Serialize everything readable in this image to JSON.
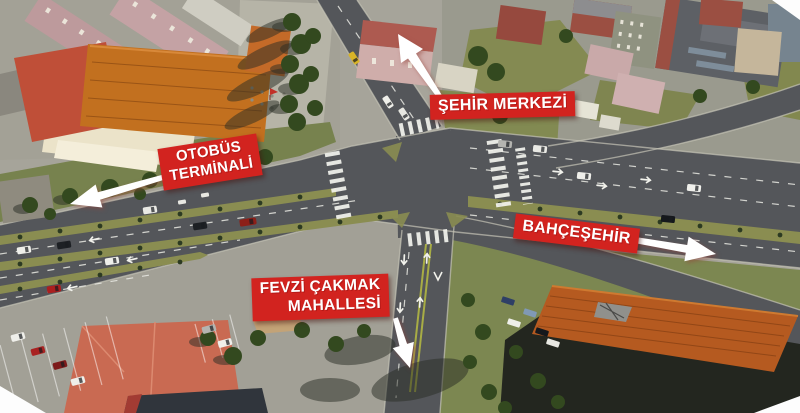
{
  "labels": {
    "city_center": "ŞEHİR MERKEZİ",
    "bus_terminal_line1": "OTOBÜS",
    "bus_terminal_line2": "TERMİNALİ",
    "bahcesehir": "BAHÇEŞEHİR",
    "fevzi_cakmak_line1": "FEVZİ ÇAKMAK",
    "fevzi_cakmak_line2": "MAHALLESİ"
  },
  "colors": {
    "banner_background": "#d2231f",
    "banner_text": "#ffffff",
    "arrow": "#ffffff",
    "road": "#54565a",
    "median": "#8a8d51",
    "grass": "#7c8751",
    "tiled_roof_orange": "#b55a20",
    "terminal_roof_orange": "#c2701f",
    "terminal_roof_red": "#bf4f38",
    "salmon_roof": "#c96a52"
  }
}
